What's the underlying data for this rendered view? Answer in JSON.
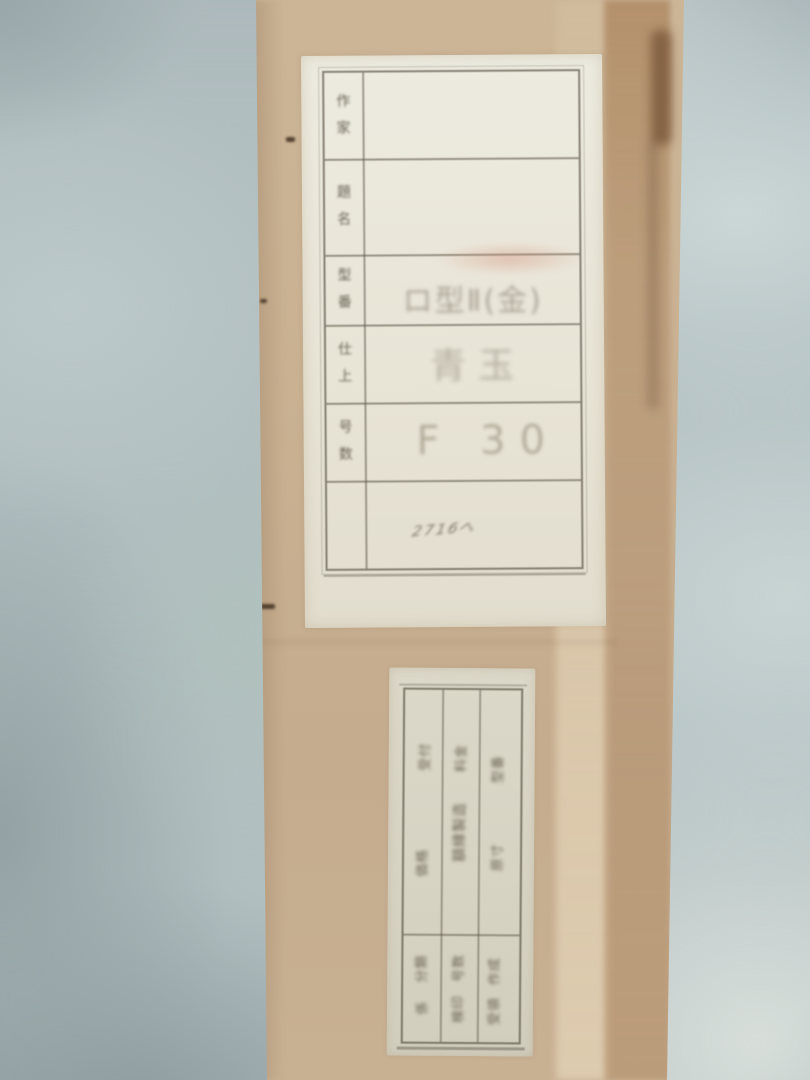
{
  "photo": {
    "subject": "cardboard canvas box leaning against wall with paper labels",
    "colors": {
      "wall_base": "#b2bfc1",
      "wall_light": "#d7deda",
      "wall_dark": "#8c999d",
      "cardboard": "#c7ae8e",
      "cardboard_edge_dark": "#7c5a3d",
      "label_paper": "#e9e5d8",
      "stamp_paper": "#d8d4c4",
      "rule_line": "#6b675a",
      "ink": "#5a5444",
      "red_smudge": "#cf876e"
    }
  },
  "main_label": {
    "rows": [
      {
        "label": "作家",
        "value": ""
      },
      {
        "label": "題名",
        "value": ""
      },
      {
        "label": "型番",
        "value": "ロ型Ⅱ(金)"
      },
      {
        "label": "仕上",
        "value": "青玉"
      },
      {
        "label": "号数",
        "value": "F 30"
      }
    ],
    "footer_note": "2716ヘ"
  },
  "stamp_label": {
    "orientation": "text rotated 90 degrees, faint stamped ink",
    "columns": [
      {
        "upper": [
          "受付",
          "価格"
        ],
        "lower": [
          "分類",
          "係"
        ]
      },
      {
        "upper": [
          "料金",
          "額縁製造"
        ],
        "lower": [
          "号数",
          "検印"
        ]
      },
      {
        "upper": [
          "型番",
          "原寸"
        ],
        "lower": [
          "作成",
          "受領"
        ]
      }
    ]
  }
}
